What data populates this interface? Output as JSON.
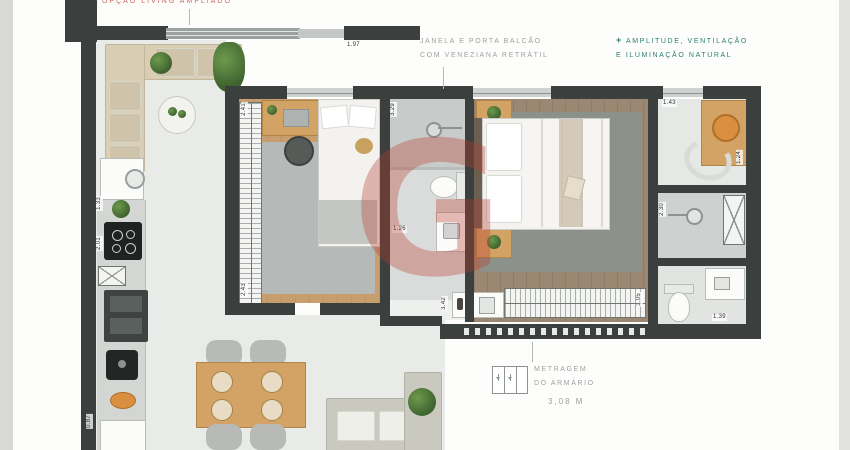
{
  "annotations": {
    "partial_top_label": "OPÇÃO LIVING AMPLIADO",
    "window_note_l1": "JANELA E PORTA BALCÃO",
    "window_note_l2": "COM VENEZIANA RETRÁTIL",
    "benefit_plus": "+",
    "benefit_l1": "AMPLITUDE, VENTILAÇÃO",
    "benefit_l2": "E ILUMINAÇÃO NATURAL",
    "closet_l1": "METRAGEM",
    "closet_l2": "DO ARMÁRIO",
    "closet_value": "3,08 M"
  },
  "watermark": {
    "letter": "G",
    "color": "#b33a31"
  },
  "colors": {
    "wall": "#3b403e",
    "accent_teal": "#2a7f72",
    "annotation_gray": "#9aa3a0",
    "living_floor": "#e9ebe8",
    "bedroom_wood": "#c79e6e",
    "master_wood": "#9c8773"
  },
  "dimensions": [
    {
      "text": "2.41"
    },
    {
      "text": "2.43"
    },
    {
      "text": "3.29"
    },
    {
      "text": "1.26"
    },
    {
      "text": "3.42"
    },
    {
      "text": "3.05"
    },
    {
      "text": "1.43"
    },
    {
      "text": "1.24"
    },
    {
      "text": "2.30"
    },
    {
      "text": "1.39"
    },
    {
      "text": "2.01"
    },
    {
      "text": "1.33"
    },
    {
      "text": "1.97"
    },
    {
      "text": "0.87"
    }
  ]
}
